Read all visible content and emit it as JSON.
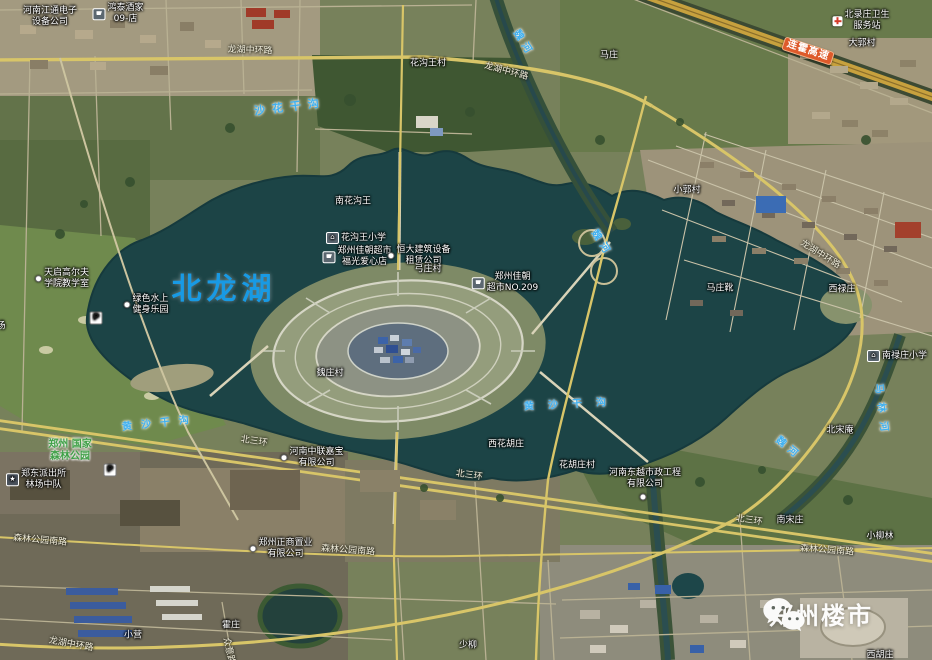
{
  "map": {
    "lake_label": {
      "text": "北龙湖"
    },
    "watermark": {
      "text": "郑州楼市",
      "icon": "wechat-icon"
    },
    "colors": {
      "poi_text": "#ffffff",
      "road_text": "#f3efdd",
      "river_text": "#3fb0f0",
      "park_text": "#3fa047",
      "lake_text": "#189AE4",
      "badge_bg": "#DE5A2B",
      "badge_text": "#ffffff",
      "watermark_text": "#ffffff",
      "water": "#1c4446",
      "expressway": "#c7a13e"
    },
    "labels": [
      {
        "text": "河南江通电子\n设备公司",
        "x": 50,
        "y": 17,
        "size": 9,
        "color": "poi"
      },
      {
        "text": "鸿泰酒家\n09-店",
        "x": 118,
        "y": 14,
        "size": 9,
        "color": "poi",
        "icon": "cart"
      },
      {
        "text": "龙湖中环路",
        "x": 250,
        "y": 51,
        "size": 9,
        "color": "road",
        "rot": 2
      },
      {
        "text": "花沟王村",
        "x": 428,
        "y": 64,
        "size": 9,
        "color": "poi"
      },
      {
        "text": "龙湖中环路",
        "x": 506,
        "y": 72,
        "size": 9,
        "color": "road",
        "rot": 15
      },
      {
        "text": "马庄",
        "x": 609,
        "y": 56,
        "size": 9,
        "color": "poi"
      },
      {
        "text": "魏河",
        "x": 523,
        "y": 44,
        "size": 10,
        "color": "river",
        "rot": 58,
        "ls": 5
      },
      {
        "text": "北录庄卫生\n服务站",
        "x": 861,
        "y": 21,
        "size": 9,
        "color": "poi",
        "icon": "cross"
      },
      {
        "text": "大郭村",
        "x": 862,
        "y": 44,
        "size": 9,
        "color": "poi"
      },
      {
        "text": "连霍高速",
        "x": 808,
        "y": 51,
        "size": 10,
        "color": "badge",
        "rot": 18,
        "name": "expressway-badge"
      },
      {
        "text": "沙花干沟",
        "x": 290,
        "y": 107,
        "size": 11,
        "color": "river",
        "rot": -7,
        "ls": 7
      },
      {
        "text": "小郭村",
        "x": 687,
        "y": 191,
        "size": 9,
        "color": "poi"
      },
      {
        "text": "南花沟王",
        "x": 353,
        "y": 202,
        "size": 9,
        "color": "poi"
      },
      {
        "text": "花沟王小学",
        "x": 356,
        "y": 238,
        "size": 9,
        "color": "poi",
        "icon": "school"
      },
      {
        "text": "郑州佳朝超市\n福光爱心店",
        "x": 357,
        "y": 257,
        "size": 9,
        "color": "poi",
        "icon": "cart"
      },
      {
        "text": "恒大建筑设备\n租赁公司",
        "x": 419,
        "y": 256,
        "size": 9,
        "color": "poi",
        "icon": "dot"
      },
      {
        "text": "弓庄村",
        "x": 428,
        "y": 270,
        "size": 9,
        "color": "poi"
      },
      {
        "text": "郑州佳朝\n超市NO.209",
        "x": 505,
        "y": 283,
        "size": 9,
        "color": "poi",
        "icon": "cart"
      },
      {
        "text": "龙湖中环路",
        "x": 820,
        "y": 255,
        "size": 9,
        "color": "road",
        "rot": 32
      },
      {
        "text": "马庄靴",
        "x": 720,
        "y": 289,
        "size": 9,
        "color": "poi"
      },
      {
        "text": "西禄庄",
        "x": 842,
        "y": 290,
        "size": 9,
        "color": "poi"
      },
      {
        "text": "魏河",
        "x": 601,
        "y": 244,
        "size": 10,
        "color": "river",
        "rot": 58,
        "ls": 5
      },
      {
        "text": "天启高尔夫\n学院教学室",
        "x": 62,
        "y": 279,
        "size": 9,
        "color": "poi",
        "icon": "dot"
      },
      {
        "text": "绿色水上\n健身乐园",
        "x": 146,
        "y": 305,
        "size": 9,
        "color": "poi",
        "icon": "dot"
      },
      {
        "icon": "parking",
        "x": 96,
        "y": 318,
        "color": "poi",
        "name": "parking-icon"
      },
      {
        "text": "场",
        "x": 1,
        "y": 327,
        "size": 9,
        "color": "poi"
      },
      {
        "text": "南禄庄小学",
        "x": 897,
        "y": 356,
        "size": 9,
        "color": "poi",
        "icon": "school"
      },
      {
        "text": "马林河",
        "x": 881,
        "y": 412,
        "size": 10,
        "color": "river",
        "rot": 83,
        "ls": 9
      },
      {
        "text": "魏庄村",
        "x": 330,
        "y": 374,
        "size": 9,
        "color": "poi"
      },
      {
        "text": "黄沙干沟",
        "x": 160,
        "y": 424,
        "size": 10,
        "color": "river",
        "rot": -6,
        "ls": 9
      },
      {
        "text": "黄沙干沟",
        "x": 572,
        "y": 405,
        "size": 10,
        "color": "river",
        "rot": -3,
        "ls": 14
      },
      {
        "text": "北宋庵",
        "x": 840,
        "y": 431,
        "size": 9,
        "color": "poi"
      },
      {
        "text": "魏河",
        "x": 788,
        "y": 449,
        "size": 10,
        "color": "river",
        "rot": 40,
        "ls": 5
      },
      {
        "text": "郑州 国家\n森林公园",
        "x": 70,
        "y": 451,
        "size": 10,
        "color": "park"
      },
      {
        "text": "北三环",
        "x": 254,
        "y": 442,
        "size": 9,
        "color": "road",
        "rot": 9
      },
      {
        "text": "河南中联嘉宝\n有限公司",
        "x": 312,
        "y": 458,
        "size": 9,
        "color": "poi",
        "icon": "dot"
      },
      {
        "text": "西花胡庄",
        "x": 506,
        "y": 445,
        "size": 9,
        "color": "poi"
      },
      {
        "text": "北三环",
        "x": 469,
        "y": 476,
        "size": 9,
        "color": "road",
        "rot": 9
      },
      {
        "text": "花胡庄村",
        "x": 577,
        "y": 466,
        "size": 9,
        "color": "poi"
      },
      {
        "text": "河南东越市政工程\n有限公司",
        "x": 645,
        "y": 479,
        "size": 9,
        "color": "poi"
      },
      {
        "icon": "dot",
        "x": 643,
        "y": 497,
        "color": "poi",
        "name": "poi-marker"
      },
      {
        "text": "郑东派出所\n林场中队",
        "x": 36,
        "y": 480,
        "size": 9,
        "color": "poi",
        "icon": "star"
      },
      {
        "icon": "parking",
        "x": 110,
        "y": 470,
        "color": "poi",
        "name": "parking-icon"
      },
      {
        "text": "郑州正商置业\n有限公司",
        "x": 281,
        "y": 549,
        "size": 9,
        "color": "poi",
        "icon": "dot"
      },
      {
        "text": "森林公园南路",
        "x": 40,
        "y": 541,
        "size": 9,
        "color": "road",
        "rot": 5
      },
      {
        "text": "森林公园南路",
        "x": 348,
        "y": 551,
        "size": 9,
        "color": "road",
        "rot": 4
      },
      {
        "text": "北三环",
        "x": 749,
        "y": 521,
        "size": 9,
        "color": "road",
        "rot": 9
      },
      {
        "text": "南宋庄",
        "x": 790,
        "y": 521,
        "size": 9,
        "color": "poi"
      },
      {
        "text": "小柳林",
        "x": 880,
        "y": 537,
        "size": 9,
        "color": "poi"
      },
      {
        "text": "森林公园南路",
        "x": 827,
        "y": 551,
        "size": 9,
        "color": "road",
        "rot": 4
      },
      {
        "text": "龙湖中环路",
        "x": 71,
        "y": 645,
        "size": 9,
        "color": "road",
        "rot": 10
      },
      {
        "text": "小营",
        "x": 133,
        "y": 636,
        "size": 9,
        "color": "poi"
      },
      {
        "text": "霍庄",
        "x": 231,
        "y": 626,
        "size": 9,
        "color": "poi"
      },
      {
        "text": "众意路",
        "x": 228,
        "y": 651,
        "size": 9,
        "color": "road",
        "rot": 78
      },
      {
        "text": "少柳",
        "x": 468,
        "y": 646,
        "size": 9,
        "color": "poi"
      },
      {
        "text": "西胡庄",
        "x": 880,
        "y": 656,
        "size": 9,
        "color": "poi"
      }
    ]
  }
}
